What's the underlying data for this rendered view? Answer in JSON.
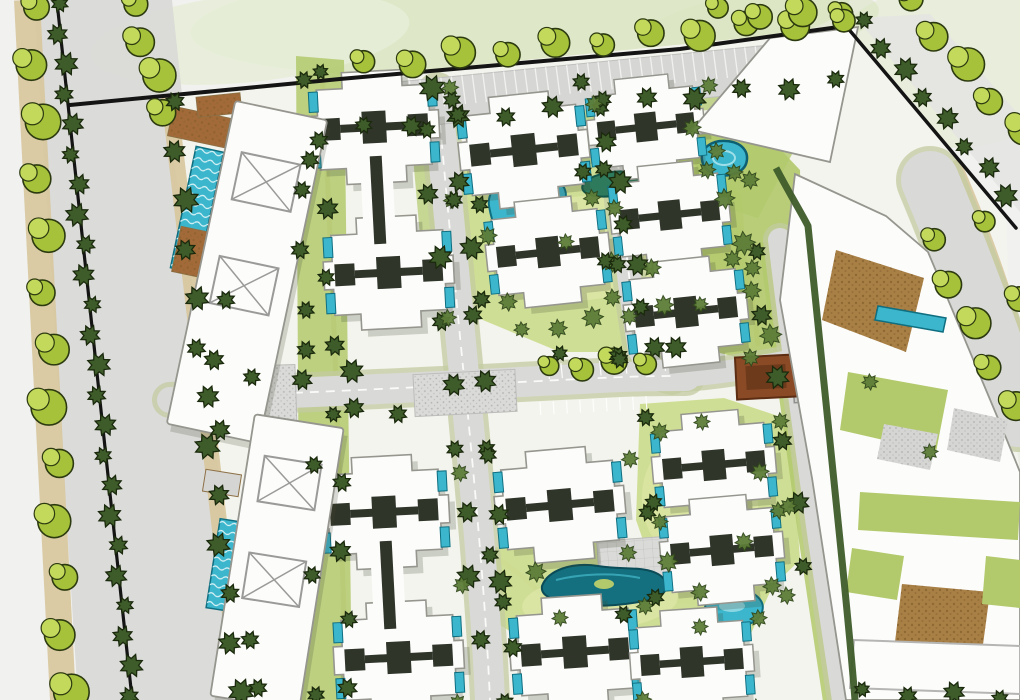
{
  "map": {
    "kind": "architectural-site-plan",
    "canvas": {
      "width": 1020,
      "height": 700
    }
  },
  "palette": {
    "paper": "#f1f1ef",
    "wash": "#dbe5c2",
    "wash2": "#e7edd8",
    "washSE": "#e9ece0",
    "road": "#d9d9d7",
    "roadVerge": "#c3cba0",
    "streetNE": "#e4e4e2",
    "tan": "#d8c8a0",
    "lawnLight": "#ccdc90",
    "lawnMid": "#b2c96c",
    "lawnPale": "#e2eaae",
    "treeLight": "#a6c23a",
    "treeLightHi": "#c3d95c",
    "treeOutline": "#2c3a10",
    "treeDark": "#3e5c2a",
    "treeDarkOutline": "#1b2a0d",
    "bush": "#5d7d38",
    "bushOutline": "#31481c",
    "bldg": "#fcfcfb",
    "bldgStroke": "#96968f",
    "shadow": "#3f4733",
    "core": "#30352a",
    "poolTeal": "#3cb6cc",
    "poolDeep": "#0f6e80",
    "poolPale": "#9fdfe9",
    "lagoonDeep": "#14707f",
    "cobble": "#a87f45",
    "cobbleDot": "#7c5a28",
    "brownDeck": "#a26a38",
    "pavilion": "#8a4a26",
    "pavilionStroke": "#5c2d12",
    "pavilionInner": "#6e3a1c",
    "black": "#141414",
    "pad": "#d5d5d3",
    "padDot": "#b2b2b0",
    "stipple": "#dadad8",
    "tick": "#f4f4f2",
    "poolFrame": "#cbcbc9",
    "gridLine": "#c2c2c0",
    "beanPond": "#2e7a5c",
    "beanEdge": "#12564a"
  },
  "washes": [
    {
      "cx": 520,
      "cy": 16,
      "rx": 330,
      "ry": 58,
      "rot": -3,
      "fill": "wash",
      "op": 0.9
    },
    {
      "cx": 250,
      "cy": 38,
      "rx": 160,
      "ry": 44,
      "rot": -6,
      "fill": "wash2",
      "op": 0.9
    },
    {
      "cx": 952,
      "cy": 66,
      "rx": 125,
      "ry": 82,
      "rot": 0,
      "fill": "wash2",
      "op": 0.9
    },
    {
      "cx": 760,
      "cy": 26,
      "rx": 120,
      "ry": 34,
      "rot": -8,
      "fill": "wash",
      "op": 0.6
    },
    {
      "cx": 1002,
      "cy": 560,
      "rx": 72,
      "ry": 115,
      "rot": 0,
      "fill": "washSE",
      "op": 0.85
    }
  ],
  "avenue": {
    "roadQuad": "34,0 172,0 246,700 78,700",
    "neStreetQuad": "856,18 1020,212 1020,116 930,14"
  },
  "siteBase": "164,96 846,28 1006,218 1014,430 1020,470 1020,700 250,700 198,320",
  "tanPaths": [
    {
      "d": "M27,0 L63,700",
      "w": 26,
      "op": 0.95
    },
    {
      "d": "M169,96 L240,700",
      "w": 16,
      "op": 0.95
    },
    {
      "d": "M916,186 C946,258 976,336 1006,424",
      "w": 8,
      "op": 0.9
    },
    {
      "d": "M956,160 C990,238 1014,306 1028,368",
      "w": 8,
      "op": 0.9
    },
    {
      "d": "M322,70 C332,260 340,470 346,692",
      "w": 5,
      "op": 0.7
    },
    {
      "d": "M712,152 C736,212 752,282 758,346",
      "w": 5,
      "op": 0.8
    },
    {
      "d": "M500,560 C540,588 560,608 552,642",
      "w": 5,
      "op": 0.8
    },
    {
      "d": "M640,560 C666,586 694,600 726,608",
      "w": 5,
      "op": 0.8
    }
  ],
  "greens": [
    {
      "pts": "462,168 580,150 688,142 742,196 748,300 688,352 560,352 478,318 456,240",
      "fill": "lawnLight",
      "op": 0.95
    },
    {
      "pts": "694,118 760,128 800,170 804,350 756,362 700,348",
      "fill": "lawnMid",
      "op": 0.9
    },
    {
      "pts": "640,404 724,398 790,420 800,560 744,614 664,600 636,520",
      "fill": "lawnLight",
      "op": 0.95
    },
    {
      "pts": "490,548 560,540 656,548 716,572 770,592 748,640 640,648 540,650 492,620",
      "fill": "lawnLight",
      "op": 0.95
    },
    {
      "pts": "296,56 344,60 352,700 300,700",
      "fill": "lawnMid",
      "op": 0.85
    },
    {
      "pts": "360,132 840,82 842,96 362,146",
      "fill": "lawnMid",
      "op": 0.75
    },
    {
      "pts": "408,100 436,96 452,230 420,236",
      "fill": "lawnMid",
      "op": 0.7
    },
    {
      "pts": "676,150 760,88 806,128 758,218 688,196",
      "fill": "lawnMid",
      "op": 0.8
    }
  ],
  "greenAccents": [
    {
      "cx": 585,
      "cy": 248,
      "rx": 95,
      "ry": 52,
      "rot": -6,
      "fill": "lawnPale",
      "op": 0.6
    },
    {
      "cx": 600,
      "cy": 602,
      "rx": 78,
      "ry": 28,
      "rot": -4,
      "fill": "lawnPale",
      "op": 0.6
    },
    {
      "cx": 700,
      "cy": 500,
      "rx": 58,
      "ry": 68,
      "rot": -6,
      "fill": "lawnPale",
      "op": 0.45
    }
  ],
  "vergeStrokes": [
    {
      "d": "M780,240 C792,340 806,440 820,540 C830,610 838,660 844,700",
      "w": 42,
      "fill": "lawnMid",
      "op": 0.85
    }
  ],
  "roads": [
    {
      "name": "road-vertical-west",
      "d": "M437,92 C448,210 458,320 468,416 C478,520 486,612 490,700",
      "w": 30,
      "dash": true
    },
    {
      "name": "road-vertical-east",
      "d": "M614,96 C618,180 626,268 640,350 C648,368 660,376 672,378",
      "w": 24,
      "dash": true
    },
    {
      "name": "road-central-spine",
      "d": "M214,396 C330,392 480,384 600,378 C640,376 660,376 686,376",
      "w": 30,
      "dash": true
    },
    {
      "name": "road-spine-east-link",
      "d": "M686,376 C730,372 764,366 794,360",
      "w": 22,
      "dash": false
    },
    {
      "name": "road-east-loop",
      "d": "M780,240 C792,340 806,440 820,540 C830,610 838,660 844,700",
      "w": 24,
      "dash": false
    },
    {
      "name": "road-entrance-stub",
      "d": "M170,400 L242,396",
      "w": 26,
      "dash": false
    },
    {
      "name": "road-se-street",
      "d": "M930,180 C960,252 990,330 1018,418",
      "w": 58,
      "dash": false
    }
  ],
  "plazas": [
    {
      "x": 208,
      "y": 366,
      "w": 88,
      "h": 62,
      "rot": -2,
      "grid": false
    },
    {
      "x": 414,
      "y": 372,
      "w": 102,
      "h": 42,
      "rot": -3,
      "grid": false
    },
    {
      "x": 598,
      "y": 538,
      "w": 92,
      "h": 40,
      "rot": -4,
      "grid": true
    }
  ],
  "parking": {
    "quad": {
      "a": [
        357,
        86
      ],
      "b": [
        839,
        38
      ],
      "c": [
        845,
        84
      ],
      "d": [
        363,
        132
      ]
    },
    "ticks": 46,
    "tickFrac": 0.62
  },
  "stallRows": [
    {
      "from": [
        548,
        364
      ],
      "to": [
        664,
        356
      ],
      "n": 10,
      "len": 15,
      "dir": [
        0.1,
        1
      ]
    },
    {
      "from": [
        540,
        402
      ],
      "to": [
        646,
        396
      ],
      "n": 9,
      "len": 13,
      "dir": [
        0.06,
        1
      ]
    }
  ],
  "blackLines": [
    {
      "pts": "57,2 132,698",
      "w": 3.2
    },
    {
      "pts": "70,105 340,79 680,49 846,26",
      "w": 4
    },
    {
      "pts": "846,26 1016,228",
      "w": 3.5
    }
  ],
  "hedges": [
    {
      "d": "M776,168 C792,198 802,214 808,226 C818,326 830,436 842,560 C848,620 852,662 855,700",
      "w": 7
    }
  ],
  "pools": {
    "kidney": "M489,206 C486,186 510,172 538,175 C566,178 572,194 560,210 C548,226 520,236 502,230 C492,226 491,216 489,206 Z",
    "bean": {
      "cx": 612,
      "cy": 184,
      "rx": 30,
      "ry": 12,
      "rot": -8
    },
    "lagoon": "M542,586 C548,570 572,562 598,566 C624,570 644,566 658,574 C672,582 668,596 650,600 C630,604 600,608 576,604 C556,600 540,598 542,586 Z",
    "lagoonIsland": {
      "cx": 604,
      "cy": 584,
      "rx": 10,
      "ry": 5
    },
    "paisley": "M706,612 C702,596 716,586 734,588 C754,590 766,600 762,612 C758,624 738,630 722,626 C712,623 708,618 706,612 Z",
    "topPool": "M702,160 C700,148 712,140 726,141 C742,142 750,152 746,164 C742,174 726,178 714,174 C706,171 703,166 702,160 Z",
    "clubPools": [
      {
        "x": 197,
        "y": 210,
        "w": 28,
        "h": 124,
        "rot": 12
      },
      {
        "x": 225,
        "y": 565,
        "w": 24,
        "h": 90,
        "rot": 9
      }
    ],
    "smallRects": [
      {
        "x": 668,
        "y": 302,
        "w": 40,
        "h": 22,
        "rot": -6
      },
      {
        "x": 681,
        "y": 452,
        "w": 18,
        "h": 30,
        "rot": -5
      }
    ]
  },
  "structures": {
    "squarePool": {
      "x": 827,
      "y": 377,
      "rot": -3,
      "ow": 68,
      "oh": 48,
      "iw": 52,
      "ih": 34
    },
    "pavilion": {
      "x": 766,
      "y": 377,
      "rot": -3,
      "w": 60,
      "h": 42
    },
    "decks": [
      {
        "x": 170,
        "y": 112,
        "w": 58,
        "h": 30,
        "rot": 12,
        "f": "brownDeck"
      },
      {
        "x": 176,
        "y": 230,
        "w": 40,
        "h": 46,
        "rot": 12,
        "f": "brownDeck"
      },
      {
        "x": 197,
        "y": 95,
        "w": 44,
        "h": 20,
        "rot": -6,
        "f": "brownDeck"
      },
      {
        "x": 188,
        "y": 354,
        "w": 40,
        "h": 26,
        "rot": 12,
        "f": "pad"
      },
      {
        "x": 204,
        "y": 472,
        "w": 36,
        "h": 22,
        "rot": 9,
        "f": "pad"
      }
    ]
  },
  "buildings": {
    "crosses": [
      {
        "x": 378,
        "y": 200,
        "rot": -3,
        "double": true
      },
      {
        "x": 388,
        "y": 585,
        "rot": -3,
        "double": true
      },
      {
        "x": 524,
        "y": 150,
        "rot": -6,
        "s": 1
      },
      {
        "x": 548,
        "y": 252,
        "rot": -6,
        "s": 0.95
      },
      {
        "x": 646,
        "y": 127,
        "rot": -6,
        "s": 0.9
      },
      {
        "x": 670,
        "y": 215,
        "rot": -6,
        "s": 0.92
      },
      {
        "x": 686,
        "y": 312,
        "rot": -6,
        "s": 0.95
      },
      {
        "x": 560,
        "y": 505,
        "rot": -5,
        "s": 1
      },
      {
        "x": 575,
        "y": 652,
        "rot": -4,
        "s": 1
      },
      {
        "x": 714,
        "y": 465,
        "rot": -5,
        "s": 0.95
      },
      {
        "x": 722,
        "y": 550,
        "rot": -5,
        "s": 0.95
      },
      {
        "x": 692,
        "y": 662,
        "rot": -4,
        "s": 0.95
      }
    ],
    "slabs": [
      {
        "x": 247,
        "y": 272,
        "w": 94,
        "h": 330,
        "rot": 12,
        "xs": [
          -92,
          14
        ]
      },
      {
        "x": 277,
        "y": 562,
        "w": 90,
        "h": 285,
        "rot": 9,
        "xs": [
          -80,
          18
        ]
      }
    ]
  },
  "rightComplex": {
    "t1": "692,130 770,38 858,27 830,162",
    "base": "795,174 886,216 928,252 1002,428 1020,472 1020,700 846,700 812,478 780,300",
    "overlays": [
      {
        "pts": "836,250 924,278 906,352 822,320",
        "f": "cobble"
      },
      {
        "pts": "878,306 946,318 943,332 875,320",
        "f": "pool"
      },
      {
        "pts": "848,372 948,390 936,452 840,430",
        "f": "lawnMid"
      },
      {
        "pts": "884,424 938,434 930,470 877,459",
        "f": "pad"
      },
      {
        "pts": "954,408 1008,420 1000,462 947,450",
        "f": "pad"
      },
      {
        "pts": "860,492 1020,502 1018,540 858,530",
        "f": "lawnMid"
      },
      {
        "pts": "852,548 904,556 897,600 846,592",
        "f": "lawnMid"
      },
      {
        "pts": "902,584 990,592 982,652 895,642",
        "f": "cobble"
      },
      {
        "pts": "986,556 1020,560 1020,608 982,604",
        "f": "lawnMid"
      },
      {
        "pts": "894,650 936,654 933,668 891,664",
        "f": "pool"
      },
      {
        "pts": "854,640 1020,646 1020,694 850,688",
        "f": "slab3d"
      }
    ]
  },
  "treeRows": [
    {
      "name": "street-trees-west-outer",
      "from": [
        30,
        6
      ],
      "to": [
        64,
        690
      ],
      "n": 13,
      "r": 15,
      "type": "light"
    },
    {
      "name": "median-hedge-trees",
      "from": [
        57,
        4
      ],
      "to": [
        132,
        696
      ],
      "n": 24,
      "r": 10,
      "type": "dark"
    },
    {
      "name": "street-trees-west-upper",
      "from": [
        130,
        4
      ],
      "to": [
        164,
        110
      ],
      "n": 4,
      "r": 14,
      "type": "light"
    },
    {
      "name": "site-edge-west-trees",
      "from": [
        172,
        102
      ],
      "to": [
        238,
        692
      ],
      "n": 13,
      "r": 11,
      "type": "dark"
    },
    {
      "name": "parking-top-trees",
      "from": [
        362,
        64
      ],
      "to": [
        840,
        16
      ],
      "n": 11,
      "r": 13,
      "type": "light"
    },
    {
      "name": "parking-bottom-trees",
      "from": [
        364,
        128
      ],
      "to": [
        836,
        82
      ],
      "n": 11,
      "r": 10,
      "type": "dark"
    },
    {
      "name": "boundary-ne-shrubs",
      "from": [
        862,
        22
      ],
      "to": [
        1008,
        194
      ],
      "n": 8,
      "r": 10,
      "type": "dark"
    },
    {
      "name": "street-trees-ne",
      "from": [
        906,
        0
      ],
      "to": [
        1018,
        130
      ],
      "n": 5,
      "r": 14,
      "type": "light"
    },
    {
      "name": "top-edge-trees",
      "from": [
        716,
        10
      ],
      "to": [
        842,
        16
      ],
      "n": 4,
      "r": 12,
      "type": "light"
    },
    {
      "name": "street-trees-se-inner",
      "from": [
        929,
        240
      ],
      "to": [
        1010,
        406
      ],
      "n": 5,
      "r": 13,
      "type": "light"
    },
    {
      "name": "street-trees-se-outer",
      "from": [
        980,
        222
      ],
      "to": [
        1020,
        296
      ],
      "n": 2,
      "r": 12,
      "type": "light"
    },
    {
      "name": "v1-west-trees",
      "from": [
        424,
        130
      ],
      "to": [
        478,
        640
      ],
      "n": 9,
      "r": 10,
      "type": "dark"
    },
    {
      "name": "v1-east-trees",
      "from": [
        455,
        115
      ],
      "to": [
        510,
        648
      ],
      "n": 9,
      "r": 10,
      "type": "dark"
    },
    {
      "name": "v2-trees",
      "from": [
        600,
        100
      ],
      "to": [
        652,
        348
      ],
      "n": 7,
      "r": 10,
      "type": "dark"
    },
    {
      "name": "h1-west-trees",
      "from": [
        252,
        380
      ],
      "to": [
        352,
        374
      ],
      "n": 3,
      "r": 10,
      "type": "dark"
    },
    {
      "name": "h1-center-trees",
      "from": [
        548,
        368
      ],
      "to": [
        644,
        360
      ],
      "n": 4,
      "r": 11,
      "type": "light"
    },
    {
      "name": "h1-east-trees",
      "from": [
        560,
        356
      ],
      "to": [
        676,
        350
      ],
      "n": 3,
      "r": 9,
      "type": "dark"
    },
    {
      "name": "v3-verge-trees",
      "from": [
        754,
        252
      ],
      "to": [
        806,
        566
      ],
      "n": 6,
      "r": 10,
      "type": "dark"
    },
    {
      "name": "west-band-hedge-trees",
      "from": [
        318,
        72
      ],
      "to": [
        350,
        688
      ],
      "n": 10,
      "r": 9,
      "type": "dark"
    },
    {
      "name": "courtyard-bush-row",
      "from": [
        522,
        332
      ],
      "to": [
        700,
        302
      ],
      "n": 6,
      "r": 9,
      "type": "bush"
    },
    {
      "name": "complex-south-trees",
      "from": [
        862,
        692
      ],
      "to": [
        1000,
        696
      ],
      "n": 4,
      "r": 9,
      "type": "dark"
    },
    {
      "name": "ne-lawn-bushes",
      "from": [
        714,
        152
      ],
      "to": [
        768,
        336
      ],
      "n": 5,
      "r": 10,
      "type": "bush"
    }
  ],
  "singleTrees": [
    [
      432,
      88,
      13,
      "dark"
    ],
    [
      488,
      236,
      9,
      "bush"
    ],
    [
      566,
      242,
      8,
      "bush"
    ],
    [
      612,
      262,
      10,
      "bush"
    ],
    [
      536,
      572,
      10,
      "bush"
    ],
    [
      668,
      562,
      10,
      "bush"
    ],
    [
      700,
      592,
      9,
      "bush"
    ],
    [
      560,
      618,
      8,
      "bush"
    ],
    [
      660,
      432,
      9,
      "bush"
    ],
    [
      702,
      422,
      8,
      "bush"
    ],
    [
      760,
      472,
      9,
      "bush"
    ],
    [
      744,
      542,
      9,
      "bush"
    ],
    [
      660,
      522,
      8,
      "bush"
    ],
    [
      700,
      627,
      8,
      "bush"
    ],
    [
      772,
      586,
      9,
      "bush"
    ],
    [
      692,
      128,
      9,
      "bush"
    ],
    [
      750,
      180,
      9,
      "bush"
    ],
    [
      870,
      382,
      8,
      "bush"
    ],
    [
      930,
      452,
      8,
      "bush"
    ],
    [
      508,
      302,
      9,
      "bush"
    ],
    [
      652,
      268,
      9,
      "bush"
    ],
    [
      354,
      408,
      10,
      "dark"
    ],
    [
      398,
      414,
      9,
      "dark"
    ],
    [
      300,
      250,
      9,
      "dark"
    ],
    [
      306,
      350,
      9,
      "dark"
    ],
    [
      310,
      160,
      9,
      "dark"
    ],
    [
      214,
      360,
      10,
      "dark"
    ],
    [
      220,
      430,
      10,
      "dark"
    ],
    [
      226,
      300,
      9,
      "dark"
    ],
    [
      250,
      640,
      9,
      "dark"
    ],
    [
      258,
      688,
      9,
      "dark"
    ]
  ]
}
